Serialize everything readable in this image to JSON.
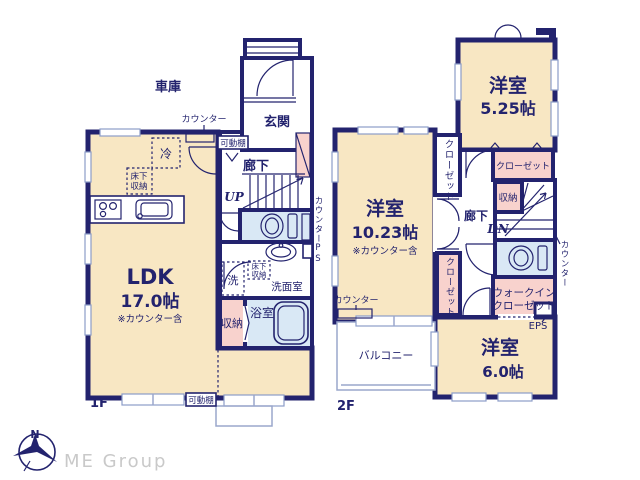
{
  "colors": {
    "wall_navy": "#23236E",
    "room_cream": "#F8E7C3",
    "closet_pink": "#F8D2CD",
    "wet_area_blue": "#D9E8F5",
    "window_line": "#8C9CC8",
    "logo_gray": "#C9C9C9"
  },
  "branding": {
    "logo": "ME Group",
    "compass_north": "N"
  },
  "floor1": {
    "label": "1F",
    "garage": "車庫",
    "counter_top": "カウンター",
    "shelf_top": "可動棚",
    "entrance": "玄関",
    "hall": "廊下",
    "up": "UP",
    "fridge": "冷",
    "underfloor_kitchen": [
      "床下",
      "収納"
    ],
    "counter_side": "カウンター",
    "ps": "PS",
    "underfloor_wash": [
      "床下",
      "収納"
    ],
    "washer": "洗",
    "washroom": "洗面室",
    "bath": "浴室",
    "storage": "収納",
    "ldk": "LDK",
    "ldk_size": "17.0帖",
    "ldk_note": "※カウンター含",
    "shelf_bottom": "可動棚"
  },
  "floor2": {
    "label": "2F",
    "room_a": "洋室",
    "room_a_size": "5.25帖",
    "closet_a": "クローゼット",
    "closet_b": "クローゼット",
    "closet_c": "クローゼット",
    "storage": "収納",
    "dn": "DN",
    "hall": "廊下",
    "room_b": "洋室",
    "room_b_size": "10.23帖",
    "room_b_note": "※カウンター含",
    "counter_left": "カウンター",
    "counter_side": "カウンター",
    "wic": [
      "ウォークイン",
      "クローゼット"
    ],
    "eps": "EPS",
    "room_c": "洋室",
    "room_c_size": "6.0帖",
    "balcony": "バルコニー"
  }
}
